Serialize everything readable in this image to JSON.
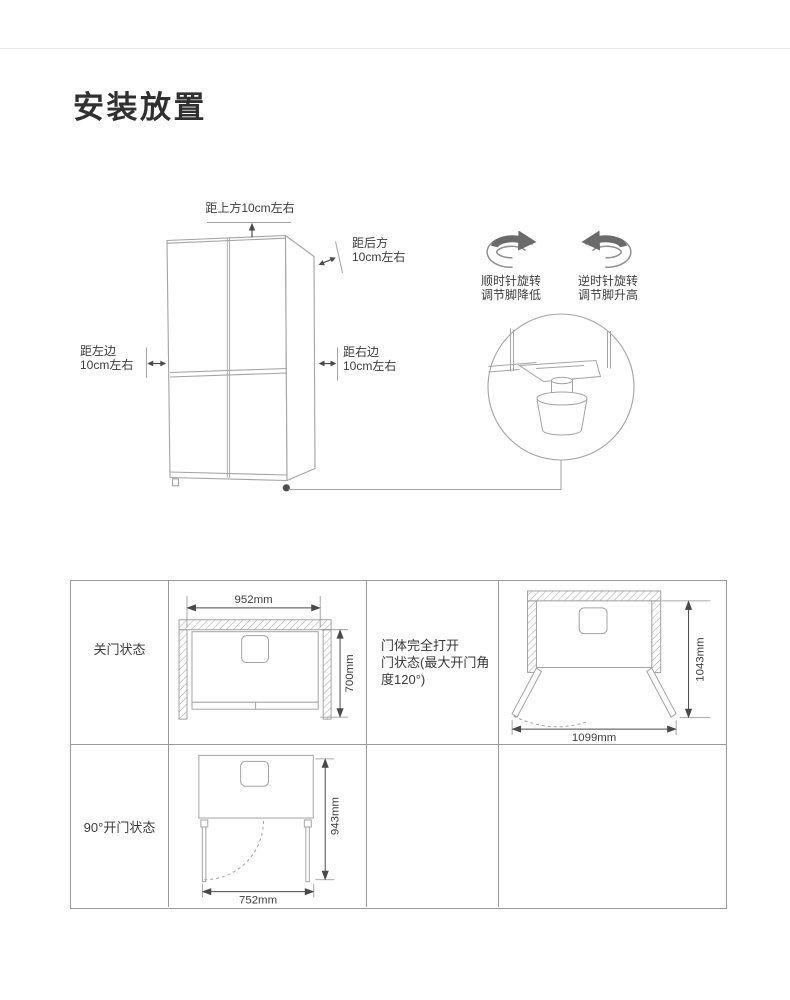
{
  "page": {
    "title": "安装放置"
  },
  "install": {
    "top_label": "距上方10cm左右",
    "back_label": "距后方\n10cm左右",
    "left_label": "距左边\n10cm左右",
    "right_label": "距右边\n10cm左右",
    "clockwise_caption": "顺时针旋转\n调节脚降低",
    "counterclockwise_caption": "逆时针旋转\n调节脚升高"
  },
  "placement_table": {
    "closed_label": "关门状态",
    "full_open_note": "门体完全打开\n门状态(最大开门角\n度120°)",
    "open90_label": "90°开门状态",
    "dims": {
      "closed_width": "952mm",
      "closed_depth": "700mm",
      "full_open_width": "1099mm",
      "full_open_depth": "1043mm",
      "open90_width": "752mm",
      "open90_depth": "943mm"
    }
  },
  "colors": {
    "line": "#a3a3a3",
    "dimension": "#4a4a4a",
    "table_border": "#9a9a9a",
    "icon_dark": "#6a6a6a"
  }
}
